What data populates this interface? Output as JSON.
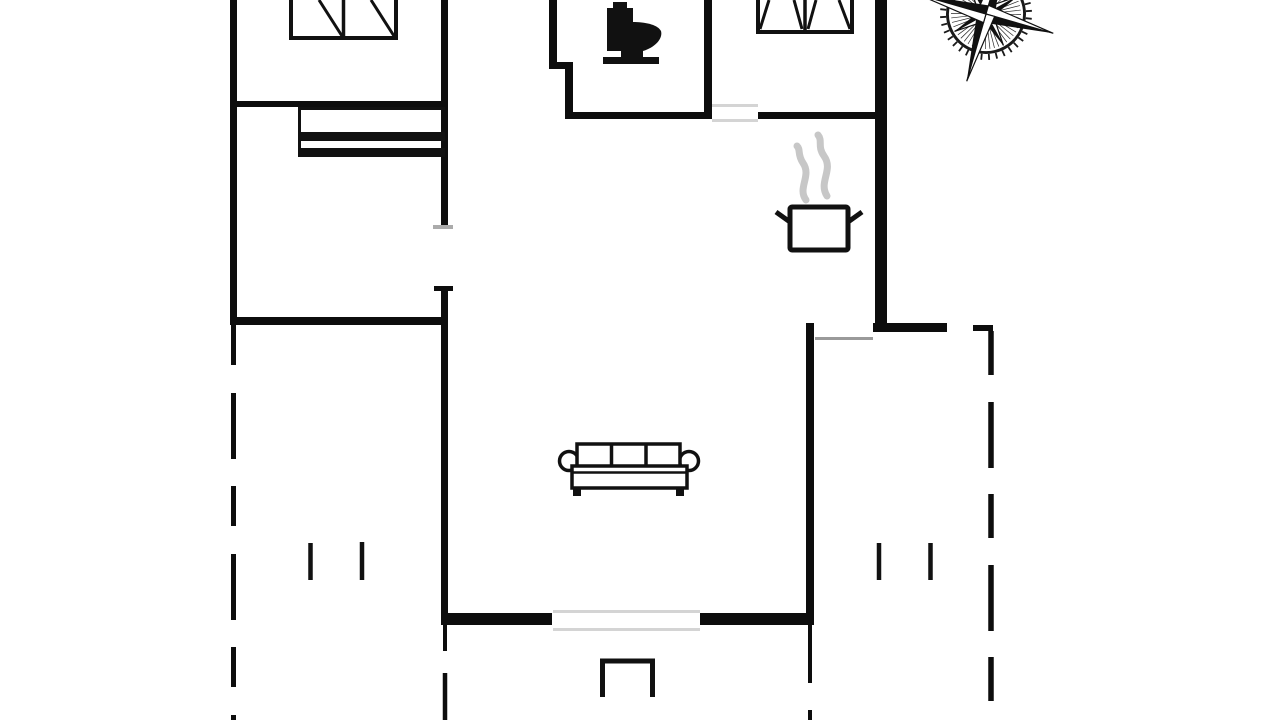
{
  "canvas": {
    "width": 1280,
    "height": 720,
    "background": "#ffffff"
  },
  "colors": {
    "wall": "#0d0d0d",
    "furniture": "#111111",
    "steam": "#c7c7c7",
    "threshold_light": "#d4d4d4",
    "threshold_mid": "#9a9a9a",
    "tick_gray": "#ababab"
  },
  "walls": [
    {
      "name": "left-outer-wall",
      "x": 230,
      "y": 0,
      "w": 7,
      "h": 325
    },
    {
      "name": "bedroom-hall-wall-upper",
      "x": 441,
      "y": 0,
      "w": 7,
      "h": 226
    },
    {
      "name": "hall-living-wall-lower",
      "x": 441,
      "y": 286,
      "w": 7,
      "h": 339
    },
    {
      "name": "bedroom1-south-wall",
      "x": 230,
      "y": 101,
      "w": 218,
      "h": 6
    },
    {
      "name": "left-room-south-wall",
      "x": 230,
      "y": 317,
      "w": 218,
      "h": 8
    },
    {
      "name": "bath-west-wall-upper",
      "x": 549,
      "y": 0,
      "w": 8,
      "h": 66
    },
    {
      "name": "bath-west-wall-jog",
      "x": 549,
      "y": 62,
      "w": 24,
      "h": 7
    },
    {
      "name": "bath-west-wall-lower",
      "x": 565,
      "y": 62,
      "w": 8,
      "h": 52
    },
    {
      "name": "bath-south-wall",
      "x": 565,
      "y": 112,
      "w": 147,
      "h": 7
    },
    {
      "name": "bath-east-wall",
      "x": 704,
      "y": 0,
      "w": 8,
      "h": 119
    },
    {
      "name": "bedroom2-south-wall",
      "x": 758,
      "y": 112,
      "w": 129,
      "h": 7
    },
    {
      "name": "right-outer-wall",
      "x": 875,
      "y": 0,
      "w": 12,
      "h": 332
    },
    {
      "name": "terrace-north-wall",
      "x": 873,
      "y": 323,
      "w": 74,
      "h": 9
    },
    {
      "name": "living-east-wall",
      "x": 806,
      "y": 323,
      "w": 8,
      "h": 302
    },
    {
      "name": "living-south-wall-west",
      "x": 441,
      "y": 613,
      "w": 111,
      "h": 12
    },
    {
      "name": "living-south-wall-east",
      "x": 700,
      "y": 613,
      "w": 114,
      "h": 12
    }
  ],
  "stubs": [
    {
      "name": "door-jamb-mark-top",
      "x": 433,
      "y": 225,
      "w": 20,
      "h": 4,
      "color": "tick_gray"
    },
    {
      "name": "door-jamb-mark-bottom",
      "x": 434,
      "y": 286,
      "w": 19,
      "h": 5,
      "color": "wall"
    },
    {
      "name": "south-west-wall-stub",
      "x": 443,
      "y": 625,
      "w": 4,
      "h": 26,
      "color": "wall"
    },
    {
      "name": "south-east-wall-stub",
      "x": 808,
      "y": 625,
      "w": 4,
      "h": 58,
      "color": "wall"
    },
    {
      "name": "terrace-corner-dash",
      "x": 973,
      "y": 325,
      "w": 20,
      "h": 6,
      "color": "wall"
    }
  ],
  "dashed_boundaries": [
    {
      "name": "left-terrace-boundary",
      "x1": 233.5,
      "y1": 325,
      "x2": 233.5,
      "y2": 724,
      "width": 5,
      "dash": "40 28 66 27"
    },
    {
      "name": "right-terrace-boundary",
      "x1": 991,
      "y1": 331,
      "x2": 991,
      "y2": 724,
      "width": 5.5,
      "dash": "44 27 66 26"
    },
    {
      "name": "left-south-dash",
      "x1": 445,
      "y1": 673,
      "x2": 445,
      "y2": 724,
      "width": 4.5,
      "dash": "none"
    },
    {
      "name": "right-south-dash",
      "x1": 810,
      "y1": 710,
      "x2": 810,
      "y2": 724,
      "width": 4,
      "dash": "none"
    }
  ],
  "door_thresholds": [
    {
      "name": "bedroom2-door-line-a",
      "x": 712,
      "y": 104,
      "w": 46,
      "h": 3,
      "color": "threshold_light"
    },
    {
      "name": "bedroom2-door-line-b",
      "x": 712,
      "y": 119,
      "w": 46,
      "h": 3,
      "color": "threshold_light"
    },
    {
      "name": "patio-door-line-a",
      "x": 553,
      "y": 610,
      "w": 147,
      "h": 3,
      "color": "threshold_light"
    },
    {
      "name": "patio-door-line-b",
      "x": 553,
      "y": 628,
      "w": 147,
      "h": 3,
      "color": "threshold_light"
    },
    {
      "name": "terrace-door-line",
      "x": 815,
      "y": 337,
      "w": 58,
      "h": 3,
      "color": "threshold_mid"
    }
  ],
  "furniture": {
    "beds": [
      {
        "name": "bed-icon-left",
        "x": 291,
        "y": -6,
        "w": 105,
        "h": 44,
        "divider_x": 343.5,
        "stroke": 4,
        "diagonals": [
          [
            319,
            0,
            342,
            36
          ],
          [
            371,
            0,
            394,
            36
          ]
        ]
      },
      {
        "name": "bed-icon-right",
        "x": 758,
        "y": -6,
        "w": 94,
        "h": 38,
        "divider_x": 805,
        "stroke": 4,
        "diagonals": [
          [
            769,
            0,
            760,
            29
          ],
          [
            794,
            0,
            802,
            29
          ],
          [
            816,
            0,
            808,
            29
          ],
          [
            839,
            0,
            850,
            29
          ]
        ]
      }
    ],
    "closet": {
      "name": "wardrobe-icon",
      "top_line": [
        298,
        108.5,
        445,
        108.5
      ],
      "left_line": [
        299.5,
        107,
        299.5,
        156
      ],
      "bars": [
        [
          298,
          132,
          147,
          9
        ],
        [
          298,
          148,
          147,
          9
        ]
      ],
      "stroke": 3
    },
    "sofa": {
      "name": "sofa-icon",
      "back": [
        577,
        444,
        103,
        28
      ],
      "dividers_x": [
        611.5,
        646
      ],
      "seat": [
        572,
        466,
        115,
        22
      ],
      "seat_line_y": 472.5,
      "arm_left": [
        569,
        461,
        9.5
      ],
      "arm_right": [
        689,
        461,
        9.5
      ],
      "legs": [
        [
          573,
          488,
          8,
          8
        ],
        [
          676,
          488,
          8,
          8
        ]
      ],
      "stroke": 3.5
    },
    "pot": {
      "name": "stove-pot-icon",
      "body": [
        790,
        207,
        58,
        43
      ],
      "stroke": 5,
      "handles": [
        [
          790,
          222,
          776,
          212
        ],
        [
          848,
          222,
          862,
          212
        ]
      ],
      "steam": [
        "M806 200 C797 188 812 176 803 163 C797 154 801 150 797 146",
        "M827 196 C818 182 834 170 824 156 C817 146 823 141 818 135"
      ],
      "steam_width": 7
    },
    "toilet": {
      "name": "toilet-icon",
      "path": "M613 2 L627 2 L627 8 L633 8 L633 22 C646 22 658 25 661 31 C663 38 656 47 643 51 L643 57 L659 57 L659 64 L603 64 L603 57 L621 57 L621 51 L607 51 L607 8 L613 8 Z"
    },
    "porch_step": {
      "name": "porch-step-icon",
      "path": "M602.5 697 L602.5 661 L652.5 661 L652.5 697",
      "stroke": 5
    },
    "terrace_posts": [
      {
        "name": "terrace-post",
        "x1": 310.5,
        "y1": 543,
        "x2": 310.5,
        "y2": 580
      },
      {
        "name": "terrace-post",
        "x1": 362,
        "y1": 542,
        "x2": 362,
        "y2": 580
      },
      {
        "name": "terrace-post",
        "x1": 879,
        "y1": 543,
        "x2": 879,
        "y2": 580
      },
      {
        "name": "terrace-post",
        "x1": 930.5,
        "y1": 543,
        "x2": 930.5,
        "y2": 580
      }
    ]
  },
  "compass": {
    "name": "compass-rose-icon",
    "cx": 986,
    "cy": 14,
    "rotation": 16,
    "ring_r": 40,
    "tick_len": 6,
    "tick_count": 36,
    "hub_r": 14,
    "hatch_r": 35,
    "cardinal_r": 70,
    "diagonal_r": 36,
    "cardinal_w": 9,
    "diagonal_w": 6.5
  }
}
